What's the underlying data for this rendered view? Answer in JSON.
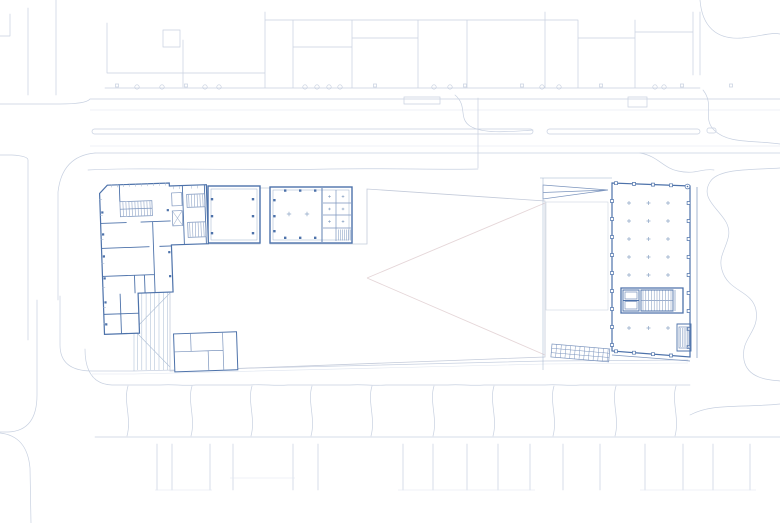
{
  "drawing": {
    "kind": "architectural-site-plan",
    "text_labels": []
  },
  "colors": {
    "bg": "#ffffff",
    "context_line": "#c7d0e0",
    "context_light": "#dfe5ef",
    "plan_line": "#4d72aa",
    "plan_mid": "#7b94bd",
    "plan_light": "#9db0cc",
    "marker": "#8fa6c6",
    "hatch_line": "#aebfd6",
    "roof_stroke": "#c4cbda",
    "roof_hip": "#e5d6d8",
    "deck_stroke": "#c3ced9"
  },
  "regions": {
    "roof_canopy": {
      "name": "roof-canopy",
      "fill": "#f8ecec"
    },
    "terrace_deck": {
      "name": "terrace-deck",
      "fill": "#dde4ea"
    }
  }
}
